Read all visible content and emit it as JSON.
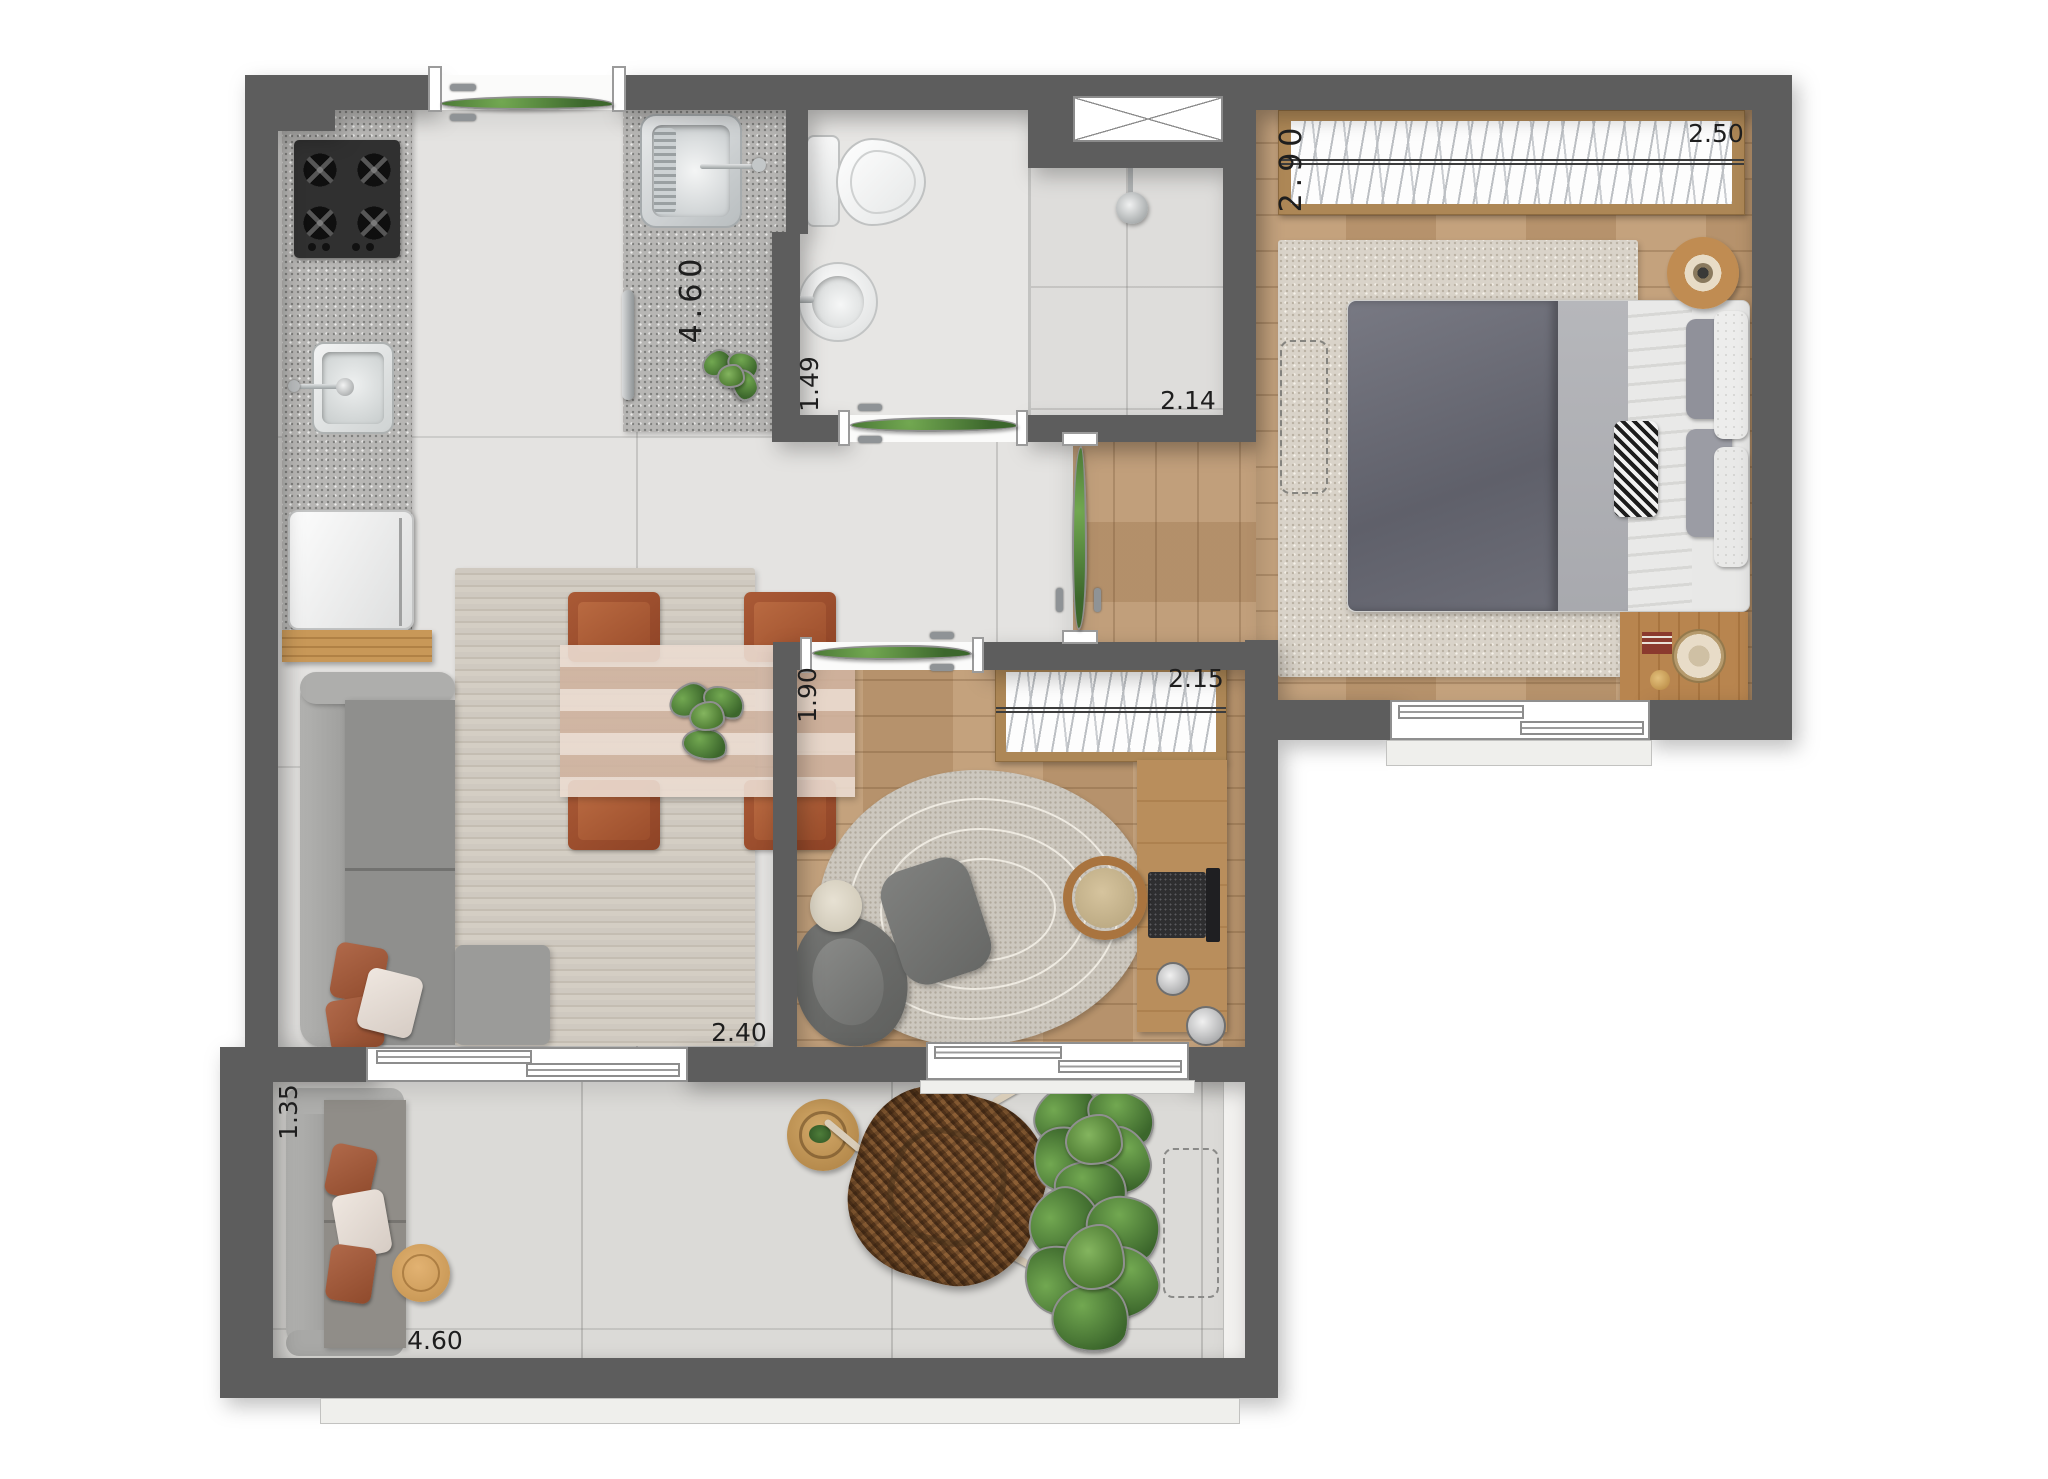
{
  "plan": {
    "type": "apartment-floor-plan-render",
    "labels": {
      "kitchen_living_width": "4.60",
      "bedroom_depth": "2.90",
      "bedroom_width": "2.50",
      "bathroom_depth": "1.49",
      "shower_width": "2.14",
      "office_depth": "1.90",
      "office_width": "2.15",
      "living_width": "2.40",
      "balcony_depth": "1.35",
      "balcony_width": "4.60"
    },
    "colors": {
      "wall": "#5d5d5d",
      "tile_floor": "#e4e3e1",
      "wood_floor": "#c09c75",
      "granite_counter": "#b7b6b4",
      "terracotta": "#9e4f2e",
      "sofa_gray": "#98978f",
      "plant_green": "#4a7a36",
      "wicker_brown": "#8a6844"
    },
    "furniture_icons": [
      "cooktop-icon",
      "kitchen-sink-icon",
      "washer-icon",
      "shelf-icon",
      "laundry-sink-icon",
      "toilet-icon",
      "washbasin-icon",
      "shower-icon",
      "double-bed-icon",
      "wardrobe-icon",
      "nightstand-icon",
      "dining-table-icon",
      "dining-chair-icon",
      "sofa-icon",
      "desk-icon",
      "laptop-icon",
      "desk-chair-icon",
      "lounge-chair-icon",
      "ottoman-icon",
      "balcony-sofa-icon",
      "wicker-chair-icon",
      "side-table-icon",
      "plant-icon",
      "ac-unit-space-icon"
    ]
  }
}
